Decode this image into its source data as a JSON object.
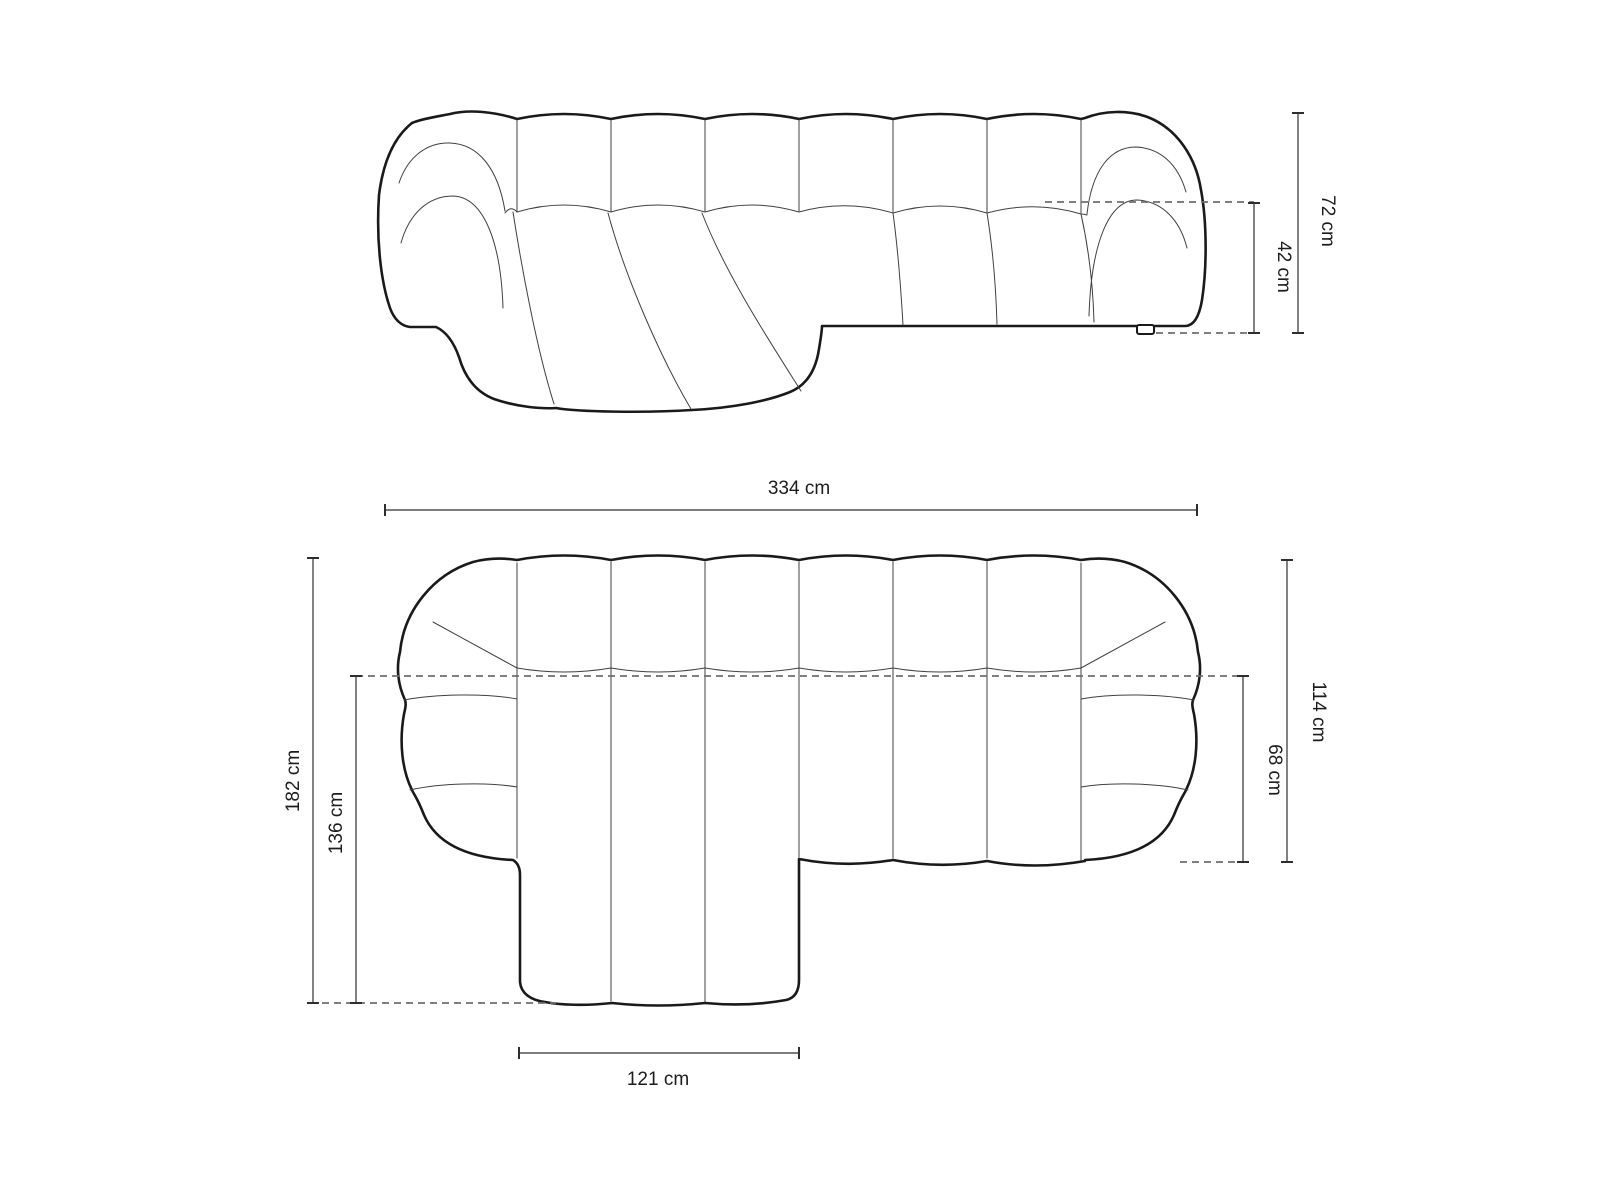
{
  "front_view": {
    "total_height_label": "72 cm",
    "seat_height_label": "42 cm"
  },
  "plan_view": {
    "total_width_label": "334 cm",
    "total_depth_label": "182 cm",
    "chaise_depth_label": "136 cm",
    "side_depth_label": "114 cm",
    "seat_depth_label": "68 cm",
    "chaise_width_label": "121 cm"
  },
  "colors": {
    "background": "#ffffff",
    "outline": "#1a1a1a",
    "detail_line": "#404040",
    "dashed_line": "#6f6f6f",
    "dimension_line": "#2e2e2e",
    "text": "#1c1c1c"
  }
}
